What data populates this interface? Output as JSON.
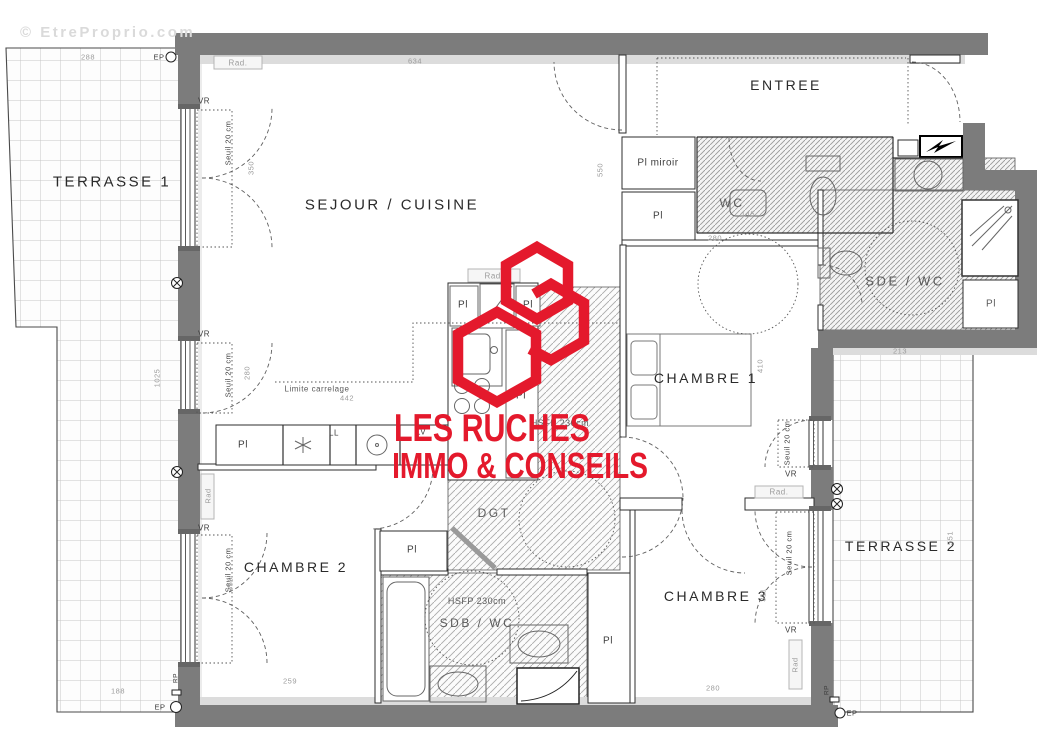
{
  "watermark": {
    "text": "© EtreProprio.com"
  },
  "logo": {
    "line1": "LES RUCHES",
    "line2": "IMMO & CONSEILS",
    "color": "#e4192c"
  },
  "rooms": [
    {
      "id": "room-label-terrasse-1",
      "text": "TERRASSE 1",
      "x": 112,
      "y": 182,
      "size": 15
    },
    {
      "id": "room-label-sejour-cuisine",
      "text": "SEJOUR / CUISINE",
      "x": 392,
      "y": 205,
      "size": 15
    },
    {
      "id": "room-label-entree",
      "text": "ENTREE",
      "x": 786,
      "y": 85,
      "size": 14
    },
    {
      "id": "room-label-wc",
      "text": "WC",
      "x": 732,
      "y": 203,
      "size": 12,
      "cls": "soft"
    },
    {
      "id": "room-label-sde-wc",
      "text": "SDE / WC",
      "x": 905,
      "y": 281,
      "size": 13,
      "cls": "soft"
    },
    {
      "id": "room-label-chambre-1",
      "text": "CHAMBRE 1",
      "x": 706,
      "y": 378,
      "size": 14
    },
    {
      "id": "room-label-chambre-2",
      "text": "CHAMBRE 2",
      "x": 296,
      "y": 567,
      "size": 14
    },
    {
      "id": "room-label-chambre-3",
      "text": "CHAMBRE 3",
      "x": 716,
      "y": 596,
      "size": 14
    },
    {
      "id": "room-label-dgt",
      "text": "DGT",
      "x": 494,
      "y": 513,
      "size": 12,
      "cls": "soft"
    },
    {
      "id": "room-label-sdb-wc",
      "text": "SDB / WC",
      "x": 477,
      "y": 623,
      "size": 12,
      "cls": "soft"
    },
    {
      "id": "room-label-terrasse-2",
      "text": "TERRASSE 2",
      "x": 901,
      "y": 546,
      "size": 14
    }
  ],
  "annotations": [
    {
      "id": "label-pl-miroir",
      "text": "Pl miroir",
      "x": 658,
      "y": 163,
      "size": 10
    },
    {
      "id": "label-pl-entree",
      "text": "Pl",
      "x": 658,
      "y": 216,
      "size": 10
    },
    {
      "id": "label-vr-1",
      "text": "VR",
      "x": 204,
      "y": 101,
      "size": 8
    },
    {
      "id": "label-vr-2",
      "text": "VR",
      "x": 204,
      "y": 334,
      "size": 8
    },
    {
      "id": "label-vr-3",
      "text": "VR",
      "x": 204,
      "y": 528,
      "size": 8
    },
    {
      "id": "label-vr-4",
      "text": "VR",
      "x": 791,
      "y": 474,
      "size": 8
    },
    {
      "id": "label-vr-5",
      "text": "VR",
      "x": 791,
      "y": 630,
      "size": 8
    },
    {
      "id": "label-seuil-1",
      "text": "Seuil 20 cm",
      "x": 228,
      "y": 143,
      "rot": 1,
      "size": 7.5
    },
    {
      "id": "label-seuil-2",
      "text": "Seuil 20 cm",
      "x": 228,
      "y": 375,
      "rot": 1,
      "size": 7.5
    },
    {
      "id": "label-seuil-3",
      "text": "Seuil 20 cm",
      "x": 228,
      "y": 570,
      "rot": 1,
      "size": 7.5
    },
    {
      "id": "label-seuil-4",
      "text": "Seuil 20 cm",
      "x": 787,
      "y": 443,
      "rot": 1,
      "size": 7.5
    },
    {
      "id": "label-seuil-5",
      "text": "Seuil 20 cm",
      "x": 789,
      "y": 553,
      "rot": 1,
      "size": 7.5
    },
    {
      "id": "label-rad-sejour",
      "text": "Rad.",
      "x": 238,
      "y": 63,
      "size": 8,
      "cls": "gray"
    },
    {
      "id": "label-rad-cuisine",
      "text": "Rad.",
      "x": 494,
      "y": 276,
      "size": 8,
      "cls": "gray"
    },
    {
      "id": "label-rad-chambre3",
      "text": "Rad.",
      "x": 779,
      "y": 492,
      "size": 8,
      "cls": "gray"
    },
    {
      "id": "label-rad-chambre2",
      "text": "Rad",
      "x": 208,
      "y": 496,
      "rot": 1,
      "size": 7.5,
      "cls": "gray"
    },
    {
      "id": "label-rad-chambre3-b",
      "text": "Rad",
      "x": 795,
      "y": 665,
      "rot": 1,
      "size": 7.5,
      "cls": "gray"
    },
    {
      "id": "label-ll",
      "text": "LL",
      "x": 334,
      "y": 433,
      "size": 8
    },
    {
      "id": "label-lv",
      "text": "LV",
      "x": 421,
      "y": 432,
      "size": 8
    },
    {
      "id": "label-pl-kitchen-1",
      "text": "Pl",
      "x": 463,
      "y": 305,
      "size": 10
    },
    {
      "id": "label-pl-kitchen-2",
      "text": "Pl",
      "x": 528,
      "y": 305,
      "size": 10
    },
    {
      "id": "label-pl-kitchen-3",
      "text": "Pl",
      "x": 521,
      "y": 396,
      "size": 10
    },
    {
      "id": "label-pl-kitchen-4",
      "text": "Pl",
      "x": 243,
      "y": 445,
      "size": 10
    },
    {
      "id": "label-pl-chambre2",
      "text": "Pl",
      "x": 412,
      "y": 550,
      "size": 10
    },
    {
      "id": "label-pl-sdb",
      "text": "Pl",
      "x": 608,
      "y": 641,
      "size": 10
    },
    {
      "id": "label-pl-sde",
      "text": "Pl",
      "x": 991,
      "y": 304,
      "size": 10,
      "cls": "soft"
    },
    {
      "id": "label-hsfp-dgt",
      "text": "HSFP 230cm",
      "x": 560,
      "y": 423,
      "size": 9,
      "cls": "soft"
    },
    {
      "id": "label-hsfp-sdb",
      "text": "HSFP 230cm",
      "x": 477,
      "y": 601,
      "size": 9,
      "cls": "soft"
    },
    {
      "id": "label-limite-carrelage",
      "text": "Limite carrelage",
      "x": 317,
      "y": 389,
      "size": 8,
      "cls": "soft"
    },
    {
      "id": "label-ep-1",
      "text": "EP",
      "x": 159,
      "y": 57,
      "size": 7.5
    },
    {
      "id": "label-ep-2",
      "text": "EP",
      "x": 160,
      "y": 707,
      "size": 7.5
    },
    {
      "id": "label-ep-3",
      "text": "EP",
      "x": 852,
      "y": 713,
      "size": 7.5
    },
    {
      "id": "label-rp-1",
      "text": "RP",
      "x": 176,
      "y": 678,
      "rot": 1,
      "size": 6.5
    },
    {
      "id": "label-rp-2",
      "text": "RP",
      "x": 827,
      "y": 690,
      "rot": 1,
      "size": 6.5
    }
  ],
  "dimensions": [
    {
      "id": "dim-288",
      "text": "288",
      "x": 88,
      "y": 57
    },
    {
      "id": "dim-634",
      "text": "634",
      "x": 415,
      "y": 61
    },
    {
      "id": "dim-550",
      "text": "550",
      "x": 600,
      "y": 170,
      "rot": 1
    },
    {
      "id": "dim-350-sejour",
      "text": "350",
      "x": 251,
      "y": 168,
      "rot": 1
    },
    {
      "id": "dim-280-sejour",
      "text": "280",
      "x": 247,
      "y": 373,
      "rot": 1
    },
    {
      "id": "dim-1025",
      "text": "1025",
      "x": 157,
      "y": 378,
      "rot": 1
    },
    {
      "id": "dim-188",
      "text": "188",
      "x": 118,
      "y": 691
    },
    {
      "id": "dim-259",
      "text": "259",
      "x": 290,
      "y": 681
    },
    {
      "id": "dim-280-chambre1",
      "text": "280",
      "x": 715,
      "y": 238
    },
    {
      "id": "dim-145",
      "text": "145",
      "x": 748,
      "y": 214
    },
    {
      "id": "dim-410",
      "text": "410",
      "x": 760,
      "y": 366,
      "rot": 1
    },
    {
      "id": "dim-280-chambre3",
      "text": "280",
      "x": 713,
      "y": 688
    },
    {
      "id": "dim-311",
      "text": "311",
      "x": 763,
      "y": 595,
      "rot": 1
    },
    {
      "id": "dim-213",
      "text": "213",
      "x": 900,
      "y": 351
    },
    {
      "id": "dim-551",
      "text": "551",
      "x": 950,
      "y": 538,
      "rot": 1
    },
    {
      "id": "dim-350-chambre2",
      "text": "350",
      "x": 230,
      "y": 584,
      "rot": 1
    },
    {
      "id": "dim-442",
      "text": "442",
      "x": 347,
      "y": 398
    }
  ]
}
